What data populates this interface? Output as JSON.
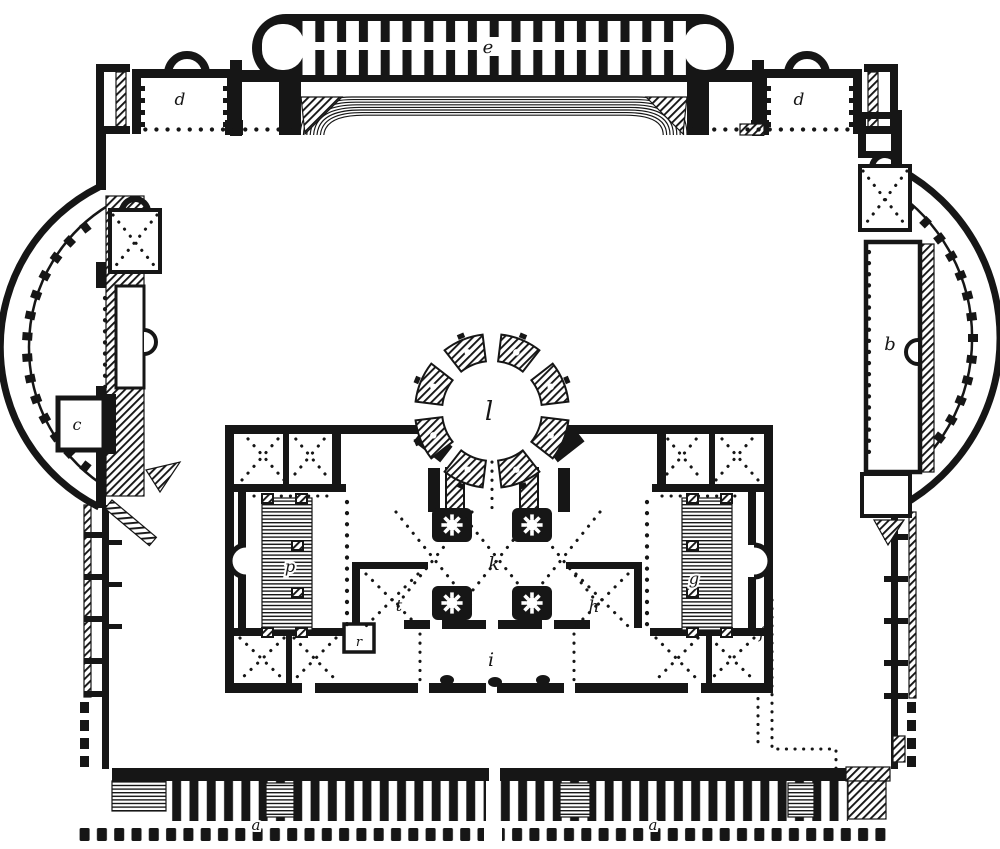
{
  "figure": {
    "type": "architectural-floor-plan-engraving",
    "background_color": "#ffffff",
    "ink_color": "#161616"
  },
  "labels": {
    "stadium_cisterns": "e",
    "hall_left": "d",
    "hall_right": "d",
    "right_exedra_hall": "b",
    "left_exedra_room": "c",
    "rotunda": "l",
    "central_hall": "k",
    "left_court": "t",
    "right_court": "h",
    "great_hall": "i",
    "left_palaestra": "p",
    "right_palaestra": "g",
    "small_room": "r",
    "aqueduct_line": "f",
    "tabernae_left": "a",
    "tabernae_right": "a"
  }
}
